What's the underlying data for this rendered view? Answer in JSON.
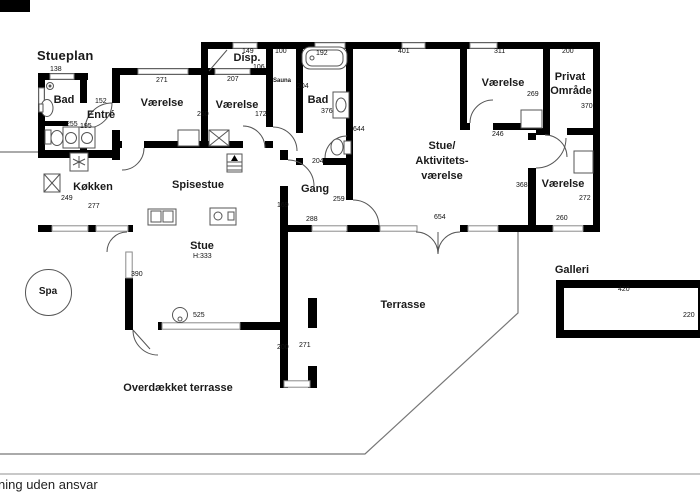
{
  "plan": {
    "title": "Stueplan",
    "rooms": {
      "bad1": "Bad",
      "entre": "Entré",
      "vaerelse1": "Værelse",
      "vaerelse2": "Værelse",
      "disp": "Disp.",
      "sauna": "Sauna",
      "bad2": "Bad",
      "vaerelse3": "Værelse",
      "privat_line1": "Privat",
      "privat_line2": "Område",
      "stueakt_line1": "Stue/",
      "stueakt_line2": "Aktivitets-",
      "stueakt_line3": "værelse",
      "vaerelse4": "Værelse",
      "koekken": "Køkken",
      "spisestue": "Spisestue",
      "stue": "Stue",
      "stue_height": "H:333",
      "gang": "Gang",
      "spa": "Spa",
      "terrasse": "Terrasse",
      "overdaekket": "Overdækket terrasse",
      "galleri": "Galleri"
    },
    "dims": {
      "bad1_width": "138",
      "entre_width": "152",
      "bad1_niche": "255",
      "entre_niche": "195",
      "vaerelse1_width": "271",
      "vaerelse1_depth": "260",
      "vaerelse2_width": "207",
      "vaerelse2_depth": "172",
      "disp_width": "149",
      "disp_depth": "106",
      "sauna_width": "100",
      "tub_width": "192",
      "bad2_upper": "204",
      "bad2_width": "376",
      "stueakt_left": "644",
      "bad2_lower": "204",
      "stueakt_width": "401",
      "vaerelse3_width": "311",
      "privat_width": "200",
      "vaerelse3_depth": "269",
      "privat_depth": "370",
      "vaerelse3_door": "246",
      "vaerelse4_opening": "368",
      "vaerelse4_depth": "272",
      "vaerelse4_width": "260",
      "terrace_door": "654",
      "gang_left": "169",
      "gang_depth": "259",
      "gang_width": "288",
      "koekken_depth": "249",
      "koekken_width": "277",
      "stue_left": "390",
      "stue_bottom": "525",
      "udhus_inner": "200",
      "udhus_outer": "271",
      "galleri_width": "420",
      "galleri_depth": "220"
    },
    "footer": "ning uden ansvar"
  }
}
